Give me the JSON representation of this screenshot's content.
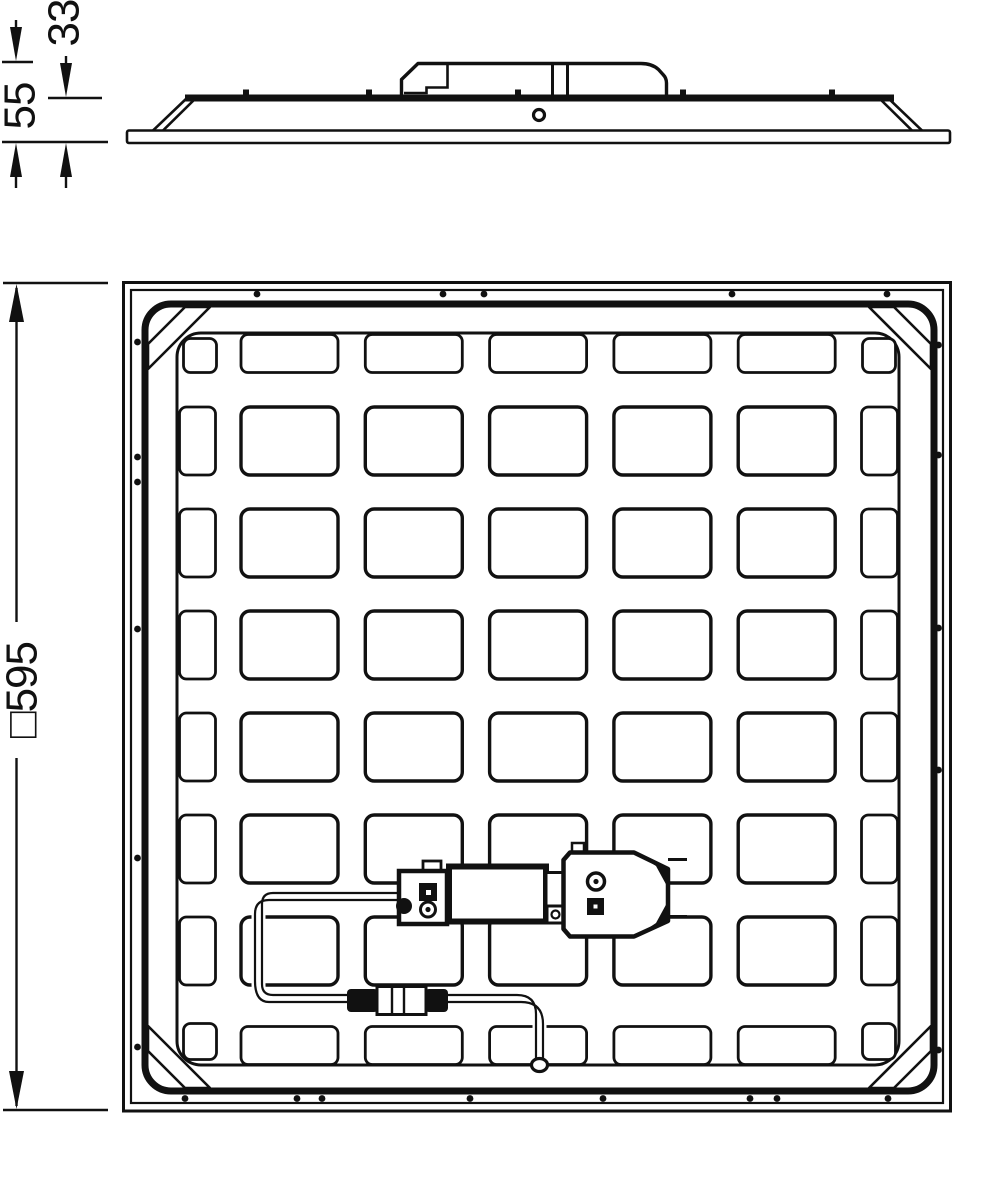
{
  "title": "luminaire-dimension-drawing",
  "colors": {
    "ink": "#111111",
    "background": "#ffffff"
  },
  "dimensions": {
    "total_height": "55",
    "panel_height": "33",
    "panel_square": "□595"
  },
  "side_view": {
    "band_ticks_x": [
      246,
      369,
      518,
      683,
      832
    ]
  },
  "back_view": {
    "rivets": {
      "radius": 3.4,
      "top": {
        "y": 294,
        "xs": [
          257,
          443,
          484,
          732,
          887
        ]
      },
      "bottom": {
        "y": 1098.5,
        "xs": [
          185,
          297,
          322,
          470,
          603,
          750,
          777,
          888
        ]
      },
      "left": {
        "x": 137.5,
        "ys": [
          342,
          457,
          482,
          629,
          858,
          1047
        ]
      },
      "right": {
        "x": 938.5,
        "ys": [
          345,
          455,
          628,
          770,
          1050
        ]
      }
    },
    "grid": {
      "cols": 5,
      "rows": 6,
      "x0": 241,
      "y0": 407,
      "cell_w": 97,
      "cell_h": 68,
      "pitch_x": 124.3,
      "pitch_y": 102,
      "cell_r": 9,
      "ring": {
        "x": 177,
        "y": 333,
        "w": 722,
        "h": 732,
        "r": 24
      },
      "edge_top": {
        "y": 334.5,
        "h": 38
      },
      "edge_bottom": {
        "y": 1026.5,
        "h": 38
      },
      "edge_left": {
        "x": 179.5,
        "w": 36
      },
      "edge_right": {
        "x": 861.5,
        "w": 36
      },
      "corner_cells": [
        {
          "x": 183.5,
          "y": 338.5,
          "w": 33,
          "h": 34
        },
        {
          "x": 862.5,
          "y": 338.5,
          "w": 33,
          "h": 34
        },
        {
          "x": 183.5,
          "y": 1023.5,
          "w": 33,
          "h": 36
        },
        {
          "x": 862.5,
          "y": 1023.5,
          "w": 33,
          "h": 36
        }
      ]
    }
  }
}
